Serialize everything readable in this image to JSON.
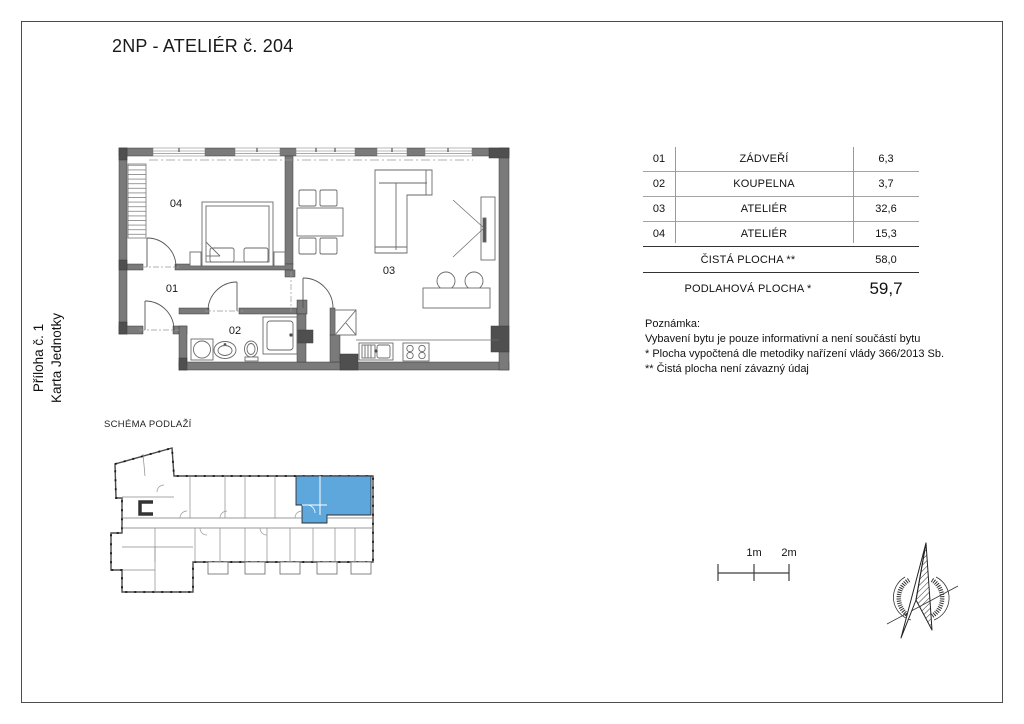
{
  "page": {
    "title": "2NP - ATELIÉR č. 204",
    "sidebar_line1": "Příloha č. 1",
    "sidebar_line2": "Karta Jednotky"
  },
  "plan": {
    "room_labels": [
      "01",
      "02",
      "03",
      "04"
    ]
  },
  "table": {
    "rows": [
      {
        "num": "01",
        "name": "ZÁDVEŘÍ",
        "area": "6,3"
      },
      {
        "num": "02",
        "name": "KOUPELNA",
        "area": "3,7"
      },
      {
        "num": "03",
        "name": "ATELIÉR",
        "area": "32,6"
      },
      {
        "num": "04",
        "name": "ATELIÉR",
        "area": "15,3"
      }
    ],
    "totals": [
      {
        "name": "ČISTÁ PLOCHA **",
        "area": "58,0"
      },
      {
        "name": "PODLAHOVÁ PLOCHA *",
        "area": "59,7"
      }
    ]
  },
  "notes": {
    "heading": "Poznámka:",
    "line1": "Vybavení bytu je pouze informativní a není součástí bytu",
    "line2": "* Plocha vypočtená dle metodiky nařízení vlády 366/2013 Sb.",
    "line3": "** Čistá plocha není závazný údaj"
  },
  "schema": {
    "label": "SCHÉMA PODLAŽÍ"
  },
  "scale_bar": {
    "label_1m": "1m",
    "label_2m": "2m"
  },
  "colors": {
    "wall": "#7a7a7a",
    "wall_dark": "#4f4f4f",
    "unit_highlight": "#5ea7dc",
    "furniture_line": "#6a6a6a"
  }
}
